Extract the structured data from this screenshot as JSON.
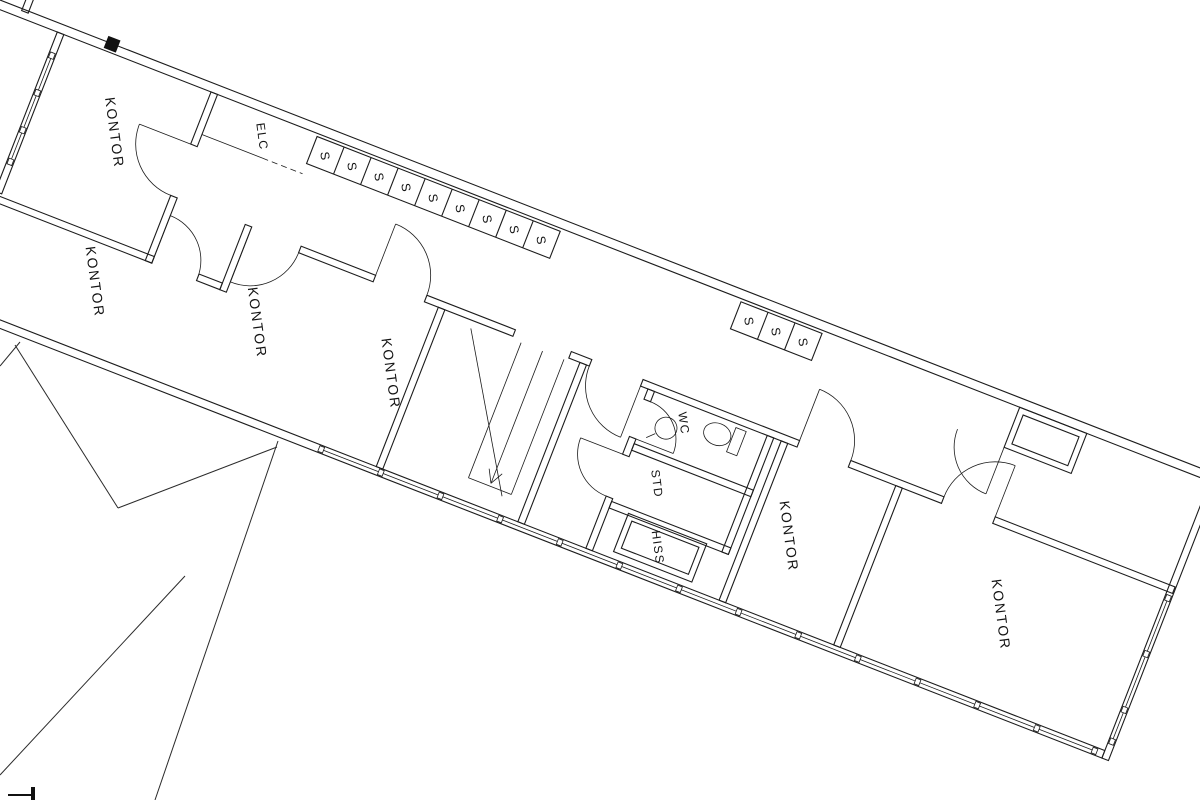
{
  "colors": {
    "background": "#ffffff",
    "line": "#1c1c1c",
    "text": "#141414"
  },
  "rooms": [
    {
      "label": "KONTOR"
    },
    {
      "label": "KONTOR"
    },
    {
      "label": "KONTOR"
    },
    {
      "label": "KONTOR"
    },
    {
      "label": "KONTOR"
    },
    {
      "label": "KONTOR"
    }
  ],
  "service": {
    "elc": "ELC",
    "wc": "WC",
    "std": "STD",
    "hiss": "HISS"
  },
  "lockers": {
    "row1": [
      "S",
      "S",
      "S",
      "S",
      "S",
      "S",
      "S",
      "S",
      "S"
    ],
    "row2": [
      "S",
      "S",
      "S"
    ]
  }
}
